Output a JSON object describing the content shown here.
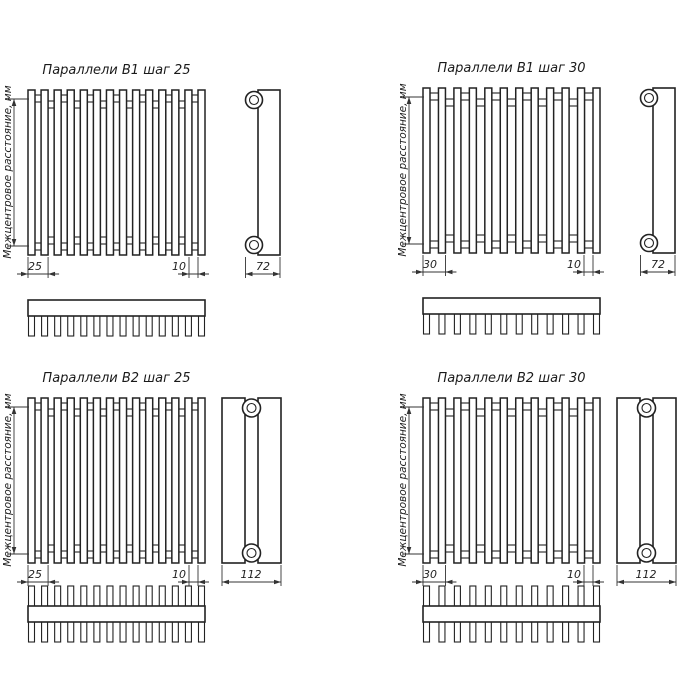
{
  "page": {
    "background": "#ffffff",
    "line_color": "#222222",
    "description_icon": "radiator-technical-drawing"
  },
  "labels": {
    "center_distance": "Межцентровое расстояние, мм"
  },
  "panels": [
    {
      "title": "Параллели В1 шаг 25",
      "model": "В1",
      "step_mm": 25,
      "tubes": 14,
      "rows": 1,
      "dims": {
        "step": "25",
        "gap": "10",
        "depth": "72"
      }
    },
    {
      "title": "Параллели В1 шаг 30",
      "model": "В1",
      "step_mm": 30,
      "tubes": 12,
      "rows": 1,
      "dims": {
        "step": "30",
        "gap": "10",
        "depth": "72"
      }
    },
    {
      "title": "Параллели В2 шаг 25",
      "model": "В2",
      "step_mm": 25,
      "tubes": 14,
      "rows": 2,
      "dims": {
        "step": "25",
        "gap": "10",
        "depth": "112"
      }
    },
    {
      "title": "Параллели В2 шаг 30",
      "model": "В2",
      "step_mm": 30,
      "tubes": 12,
      "rows": 2,
      "dims": {
        "step": "30",
        "gap": "10",
        "depth": "112"
      }
    }
  ]
}
